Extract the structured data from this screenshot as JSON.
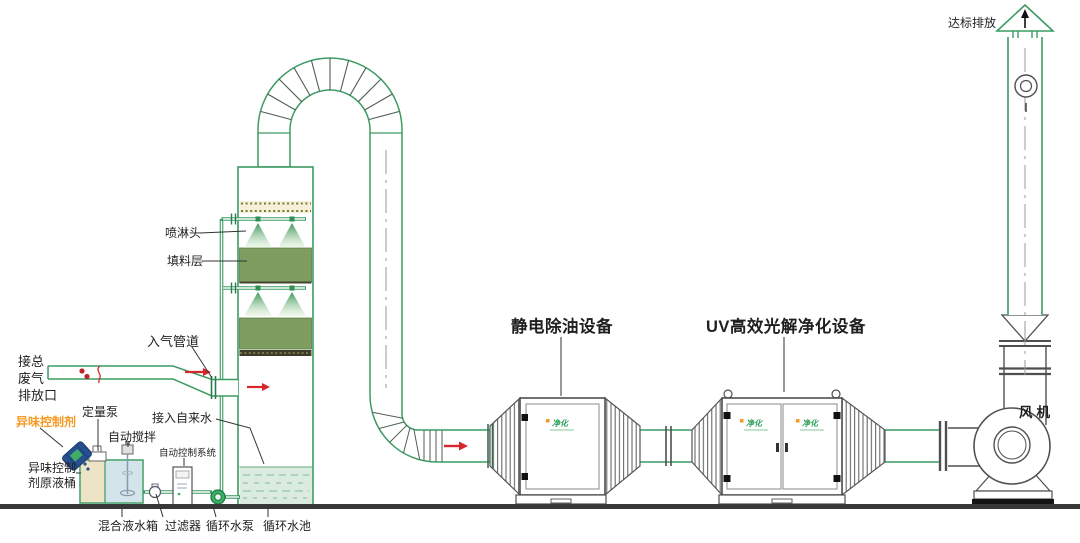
{
  "diagram": {
    "type": "waste-gas-treatment-process-flow",
    "colors": {
      "pipe_green": "#3c9b64",
      "packing_green": "#7d9e60",
      "pool_water": "#dcebe0",
      "demister_cream": "#f6f0d8",
      "tank_blue": "#d3e4ea",
      "tank_beige": "#ece4c4",
      "barrel_blue": "#27508f",
      "highlight_orange": "#f59a23",
      "arrow_red": "#d8262c",
      "equipment_gray": "#4f4f4f",
      "logo_green": "#2fa05a",
      "ground_dark": "#383838"
    },
    "labels": {
      "waste_gas_line1": "接总",
      "waste_gas_line2": "废气",
      "waste_gas_line3": "排放口",
      "inlet_pipe": "入气管道",
      "spray_head": "喷淋头",
      "packing_layer": "填料层",
      "odor_agent": "异味控制剂",
      "metering_pump": "定量泵",
      "auto_stir": "自动搅拌",
      "auto_control_system": "自动控制系统",
      "tap_water": "接入自来水",
      "agent_tank_line1": "异味控制",
      "agent_tank_line2": "剂原液桶",
      "mixing_tank": "混合液水箱",
      "filter": "过滤器",
      "circulating_pump": "循环水泵",
      "circulating_pool": "循环水池",
      "esp_unit": "静电除油设备",
      "uv_unit": "UV高效光解净化设备",
      "fan": "风机",
      "discharge": "达标排放",
      "brand_logo": "净化"
    }
  }
}
